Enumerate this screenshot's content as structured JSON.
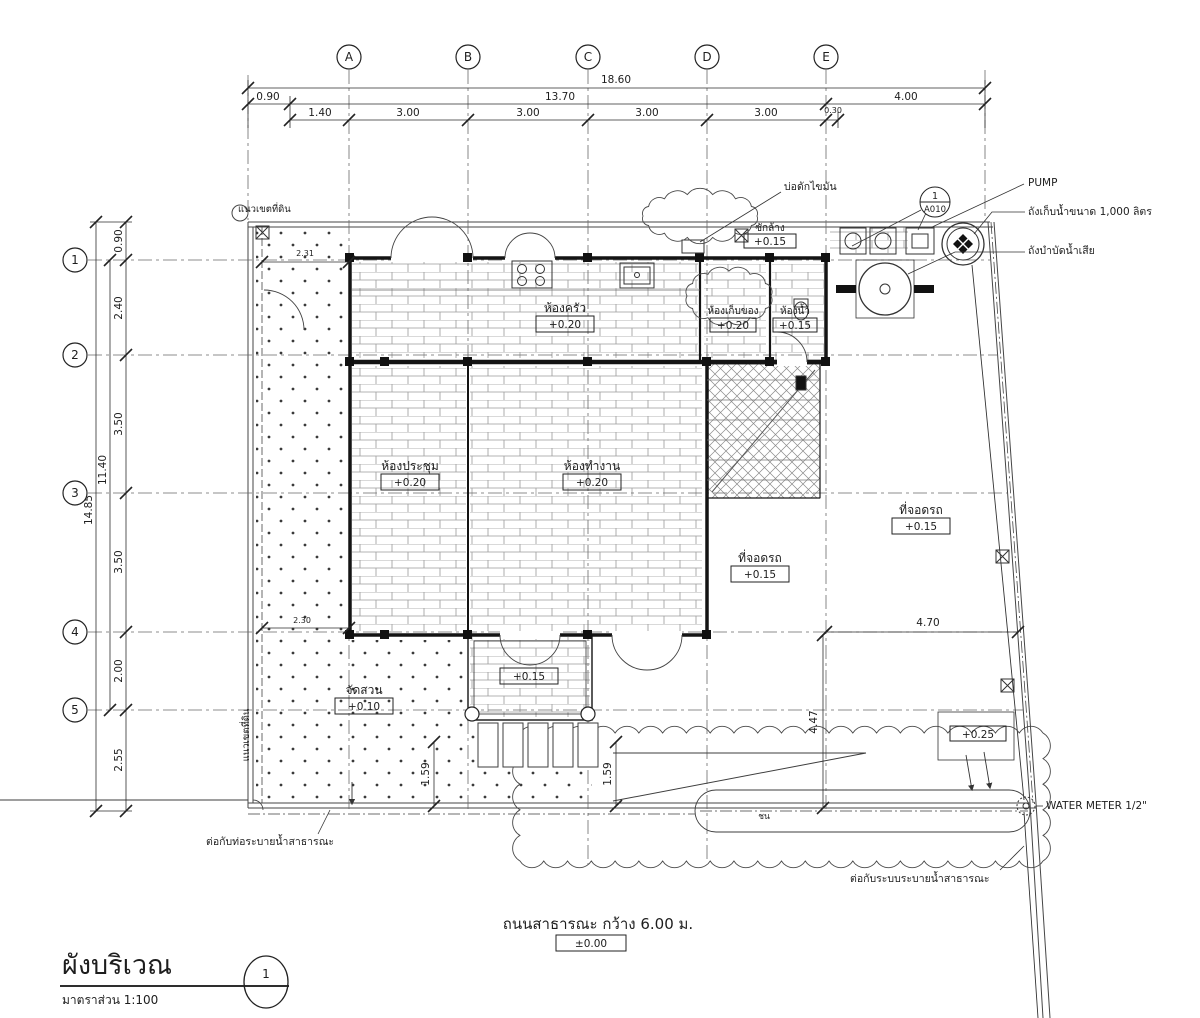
{
  "meta": {
    "title": "ผังบริเวณ",
    "scale": "มาตราส่วน 1:100",
    "view_number": "1"
  },
  "grid": {
    "cols": {
      "a": "A",
      "b": "B",
      "c": "C",
      "d": "D",
      "e": "E"
    },
    "rows": {
      "r1": "1",
      "r2": "2",
      "r3": "3",
      "r4": "4",
      "r5": "5"
    }
  },
  "dims": {
    "total_w": "18.60",
    "w_left": "0.90",
    "w_mid": "13.70",
    "w_right": "4.00",
    "c0": "1.40",
    "c1": "3.00",
    "c2": "3.00",
    "c3": "3.00",
    "c4": "3.00",
    "c5": "0.30",
    "total_h": "14.85",
    "h_span": "11.40",
    "h0": "0.90",
    "h1": "2.40",
    "h2": "3.50",
    "h3": "3.50",
    "h4": "2.00",
    "h5": "2.55",
    "d_topleft": "2.31",
    "d_midleft": "2.30",
    "d_park_w": "4.70",
    "d_park_h": "4.47",
    "d_walk1": "1.59",
    "d_walk2": "1.59"
  },
  "rooms": {
    "kitchen": {
      "name": "ห้องครัว",
      "level": "+0.20"
    },
    "storage": {
      "name": "ห้องเก็บของ",
      "level": "+0.20"
    },
    "bath": {
      "name": "ห้องน้ำ",
      "level": "+0.15"
    },
    "meeting": {
      "name": "ห้องประชุม",
      "level": "+0.20"
    },
    "office": {
      "name": "ห้องทำงาน",
      "level": "+0.20"
    },
    "parking1": {
      "name": "ที่จอดรถ",
      "level": "+0.15"
    },
    "parking2": {
      "name": "ที่จอดรถ",
      "level": "+0.15"
    },
    "garden": {
      "name": "จัดสวน",
      "level": "+0.10"
    },
    "laundry": {
      "name": "ซักล้าง",
      "level": "+0.15"
    },
    "terrace": {
      "level": "+0.15"
    },
    "side": {
      "level": "+0.25"
    }
  },
  "road": {
    "name": "ถนนสาธารณะ กว้าง 6.00 ม.",
    "level": "±0.00",
    "curb": "ชน"
  },
  "callout": {
    "num": "1",
    "sheet": "A010"
  },
  "notes": {
    "pump": "PUMP",
    "tank_supply": "ถังเก็บน้ำขนาด 1,000 ลิตร",
    "tank_waste": "ถังบำบัดน้ำเสีย",
    "grease": "บ่อดักไขมัน",
    "boundary_top": "แนวเขตที่ดิน",
    "boundary_left": "แนวเขตที่ดิน",
    "drain_pipe": "ต่อกับท่อระบายน้ำสาธารณะ",
    "drain_sys": "ต่อกับระบบระบายน้ำสาธารณะ",
    "water_meter": "WATER METER 1/2\""
  }
}
